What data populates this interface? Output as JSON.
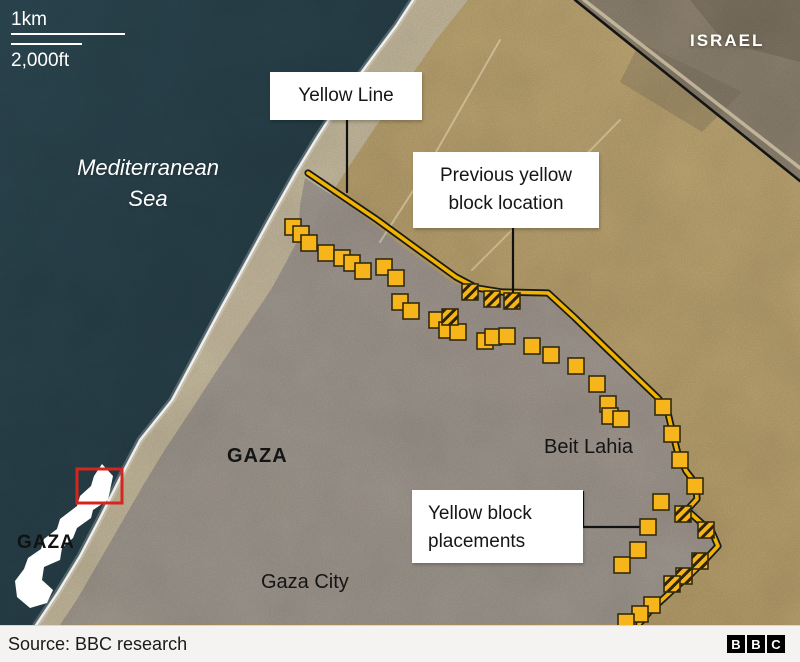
{
  "header": {
    "scale_top": "1km",
    "scale_bottom": "2,000ft"
  },
  "map_labels": {
    "israel": "ISRAEL",
    "sea": {
      "line1": "Mediterranean",
      "line2": "Sea"
    },
    "gaza_region": "GAZA",
    "beit_lahia": "Beit Lahia",
    "gaza_city": "Gaza City",
    "inset_gaza": "GAZA"
  },
  "callouts": {
    "yellow_line": {
      "label": "Yellow Line"
    },
    "previous_block": {
      "line1": "Previous yellow",
      "line2": "block location"
    },
    "placements": {
      "line1": "Yellow block",
      "line2": "placements"
    }
  },
  "footer": {
    "source": "Source: BBC research",
    "logo": [
      "B",
      "B",
      "C"
    ]
  },
  "colors": {
    "sea": "#2e4b56",
    "sand": "#d2b678",
    "israel_terrain": "#a39680",
    "urban": "#b6aea6",
    "beach": "#e3d7ba",
    "block_yellow": "#f6b61b",
    "block_border": "#332a0b",
    "line_yellow": "#f0b400",
    "line_black": "#1a1a1a",
    "border_black": "#141414",
    "highlight_red": "#d6251f",
    "label_bg": "#ffffff",
    "text_dark": "#161616",
    "footer_bg": "#f4f3f1",
    "text_white": "#ffffff"
  },
  "map_data": {
    "block_size": 16,
    "block_fill": "#f6b61b",
    "block_stroke": "#332a0b",
    "regions": [
      {
        "name": "land-sand",
        "points": [
          [
            0,
            0
          ],
          [
            800,
            0
          ],
          [
            800,
            625
          ],
          [
            0,
            625
          ]
        ],
        "fill": "url(#landGrad)"
      },
      {
        "name": "israel-terrain",
        "points": [
          [
            575,
            0
          ],
          [
            800,
            0
          ],
          [
            800,
            182
          ]
        ],
        "fill": "#a39680"
      },
      {
        "name": "israel-dark-patch-1",
        "points": [
          [
            690,
            0
          ],
          [
            800,
            0
          ],
          [
            800,
            62
          ],
          [
            724,
            42
          ]
        ],
        "fill": "#7d7260",
        "opacity": 0.45
      },
      {
        "name": "israel-dark-patch-2",
        "points": [
          [
            640,
            42
          ],
          [
            742,
            92
          ],
          [
            702,
            132
          ],
          [
            620,
            82
          ]
        ],
        "fill": "#8a7e6a",
        "opacity": 0.35
      },
      {
        "name": "beach-strip",
        "points": [
          [
            413,
            0
          ],
          [
            468,
            0
          ],
          [
            436,
            40
          ],
          [
            404,
            86
          ],
          [
            372,
            132
          ],
          [
            340,
            180
          ],
          [
            306,
            236
          ],
          [
            272,
            288
          ],
          [
            244,
            330
          ],
          [
            216,
            372
          ],
          [
            190,
            412
          ],
          [
            166,
            448
          ],
          [
            144,
            484
          ],
          [
            122,
            522
          ],
          [
            100,
            560
          ],
          [
            78,
            598
          ],
          [
            60,
            625
          ],
          [
            36,
            625
          ],
          [
            58,
            592
          ],
          [
            80,
            556
          ],
          [
            100,
            518
          ],
          [
            120,
            478
          ],
          [
            140,
            440
          ],
          [
            172,
            400
          ],
          [
            196,
            355
          ],
          [
            220,
            310
          ],
          [
            243,
            268
          ],
          [
            268,
            222
          ],
          [
            296,
            172
          ],
          [
            318,
            136
          ],
          [
            344,
            96
          ],
          [
            372,
            58
          ],
          [
            396,
            26
          ]
        ],
        "fill": "#e3d7ba",
        "opacity": 0.92
      },
      {
        "name": "urban-area",
        "points": [
          [
            305,
            178
          ],
          [
            352,
            208
          ],
          [
            402,
            246
          ],
          [
            452,
            282
          ],
          [
            480,
            292
          ],
          [
            548,
            298
          ],
          [
            592,
            340
          ],
          [
            642,
            388
          ],
          [
            663,
            412
          ],
          [
            670,
            445
          ],
          [
            684,
            477
          ],
          [
            692,
            505
          ],
          [
            706,
            524
          ],
          [
            714,
            547
          ],
          [
            698,
            568
          ],
          [
            668,
            597
          ],
          [
            638,
            624
          ],
          [
            92,
            624
          ],
          [
            60,
            625
          ],
          [
            78,
            598
          ],
          [
            100,
            560
          ],
          [
            122,
            522
          ],
          [
            144,
            484
          ],
          [
            166,
            448
          ],
          [
            190,
            412
          ],
          [
            216,
            372
          ],
          [
            244,
            330
          ],
          [
            272,
            288
          ],
          [
            298,
            240
          ],
          [
            300,
            205
          ]
        ],
        "fill": "#b6aea6",
        "opacity": 0.96
      },
      {
        "name": "sea",
        "points": [
          [
            0,
            0
          ],
          [
            413,
            0
          ],
          [
            396,
            26
          ],
          [
            372,
            58
          ],
          [
            344,
            96
          ],
          [
            318,
            136
          ],
          [
            296,
            172
          ],
          [
            268,
            222
          ],
          [
            243,
            268
          ],
          [
            220,
            310
          ],
          [
            196,
            355
          ],
          [
            172,
            400
          ],
          [
            140,
            440
          ],
          [
            120,
            478
          ],
          [
            100,
            518
          ],
          [
            80,
            556
          ],
          [
            58,
            592
          ],
          [
            36,
            625
          ],
          [
            0,
            625
          ]
        ],
        "fill": "url(#seaGrad)"
      }
    ],
    "lines": [
      {
        "name": "sand-road-1",
        "points": [
          [
            500,
            40
          ],
          [
            420,
            180
          ],
          [
            380,
            242
          ]
        ],
        "stroke": "#e8dcbc",
        "width": 2,
        "opacity": 0.5
      },
      {
        "name": "sand-road-2",
        "points": [
          [
            620,
            120
          ],
          [
            520,
            222
          ],
          [
            472,
            270
          ]
        ],
        "stroke": "#e8dcbc",
        "width": 2,
        "opacity": 0.45
      },
      {
        "name": "israel-border-road",
        "points": [
          [
            584,
            0
          ],
          [
            800,
            168
          ]
        ],
        "stroke": "#cfc3a8",
        "width": 3.5,
        "opacity": 0.8
      },
      {
        "name": "israel-border",
        "points": [
          [
            575,
            0
          ],
          [
            800,
            181
          ]
        ],
        "stroke": "#141414",
        "width": 2.6
      },
      {
        "name": "coast-surf-glow",
        "points": [
          [
            413,
            0
          ],
          [
            396,
            26
          ],
          [
            372,
            58
          ],
          [
            344,
            96
          ],
          [
            318,
            136
          ],
          [
            296,
            172
          ],
          [
            268,
            222
          ],
          [
            243,
            268
          ],
          [
            220,
            310
          ],
          [
            196,
            355
          ],
          [
            172,
            400
          ],
          [
            140,
            440
          ],
          [
            120,
            478
          ],
          [
            100,
            518
          ],
          [
            80,
            556
          ],
          [
            58,
            592
          ],
          [
            36,
            625
          ]
        ],
        "stroke": "#ffffff",
        "width": 7,
        "opacity": 0.22
      },
      {
        "name": "coast-surf",
        "points": [
          [
            413,
            0
          ],
          [
            396,
            26
          ],
          [
            372,
            58
          ],
          [
            344,
            96
          ],
          [
            318,
            136
          ],
          [
            296,
            172
          ],
          [
            268,
            222
          ],
          [
            243,
            268
          ],
          [
            220,
            310
          ],
          [
            196,
            355
          ],
          [
            172,
            400
          ],
          [
            140,
            440
          ],
          [
            120,
            478
          ],
          [
            100,
            518
          ],
          [
            80,
            556
          ],
          [
            58,
            592
          ],
          [
            36,
            625
          ]
        ],
        "stroke": "#ffffff",
        "width": 2.4,
        "opacity": 0.85
      },
      {
        "name": "yellow-line-outline",
        "points": [
          [
            308,
            173
          ],
          [
            336,
            192
          ],
          [
            376,
            219
          ],
          [
            420,
            251
          ],
          [
            456,
            277
          ],
          [
            477,
            288
          ],
          [
            502,
            292
          ],
          [
            548,
            293
          ],
          [
            574,
            317
          ],
          [
            608,
            350
          ],
          [
            658,
            398
          ],
          [
            667,
            409
          ],
          [
            672,
            430
          ],
          [
            678,
            454
          ],
          [
            686,
            471
          ],
          [
            696,
            484
          ],
          [
            697,
            499
          ],
          [
            687,
            510
          ],
          [
            698,
            520
          ],
          [
            712,
            532
          ],
          [
            718,
            546
          ],
          [
            706,
            559
          ],
          [
            690,
            575
          ],
          [
            676,
            587
          ],
          [
            663,
            599
          ],
          [
            650,
            611
          ],
          [
            639,
            624
          ]
        ],
        "stroke": "#1a1a1a",
        "width": 7.2
      },
      {
        "name": "yellow-line",
        "points": [
          [
            308,
            173
          ],
          [
            336,
            192
          ],
          [
            376,
            219
          ],
          [
            420,
            251
          ],
          [
            456,
            277
          ],
          [
            477,
            288
          ],
          [
            502,
            292
          ],
          [
            548,
            293
          ],
          [
            574,
            317
          ],
          [
            608,
            350
          ],
          [
            658,
            398
          ],
          [
            667,
            409
          ],
          [
            672,
            430
          ],
          [
            678,
            454
          ],
          [
            686,
            471
          ],
          [
            696,
            484
          ],
          [
            697,
            499
          ],
          [
            687,
            510
          ],
          [
            698,
            520
          ],
          [
            712,
            532
          ],
          [
            718,
            546
          ],
          [
            706,
            559
          ],
          [
            690,
            575
          ],
          [
            676,
            587
          ],
          [
            663,
            599
          ],
          [
            650,
            611
          ],
          [
            639,
            624
          ]
        ],
        "stroke": "#f0b400",
        "width": 3.6
      },
      {
        "name": "leader-yellow-line",
        "points": [
          [
            347,
            118
          ],
          [
            347,
            192
          ]
        ],
        "stroke": "#111111",
        "width": 2.2
      },
      {
        "name": "leader-previous-block",
        "points": [
          [
            513,
            226
          ],
          [
            513,
            294
          ]
        ],
        "stroke": "#111111",
        "width": 2.2
      },
      {
        "name": "leader-placements",
        "points": [
          [
            583,
            492
          ],
          [
            583,
            527
          ],
          [
            644,
            527
          ]
        ],
        "stroke": "#111111",
        "width": 2.2
      }
    ],
    "solid_blocks": [
      [
        293,
        227
      ],
      [
        301,
        234
      ],
      [
        309,
        243
      ],
      [
        326,
        253
      ],
      [
        342,
        258
      ],
      [
        352,
        263
      ],
      [
        363,
        271
      ],
      [
        384,
        267
      ],
      [
        396,
        278
      ],
      [
        400,
        302
      ],
      [
        411,
        311
      ],
      [
        437,
        320
      ],
      [
        447,
        330
      ],
      [
        458,
        332
      ],
      [
        485,
        341
      ],
      [
        493,
        337
      ],
      [
        507,
        336
      ],
      [
        532,
        346
      ],
      [
        551,
        355
      ],
      [
        576,
        366
      ],
      [
        597,
        384
      ],
      [
        608,
        404
      ],
      [
        610,
        416
      ],
      [
        621,
        419
      ],
      [
        663,
        407
      ],
      [
        672,
        434
      ],
      [
        680,
        460
      ],
      [
        695,
        486
      ],
      [
        661,
        502
      ],
      [
        648,
        527
      ],
      [
        638,
        550
      ],
      [
        622,
        565
      ],
      [
        652,
        605
      ],
      [
        640,
        614
      ],
      [
        626,
        622
      ]
    ],
    "hatched_blocks": [
      [
        470,
        292
      ],
      [
        492,
        299
      ],
      [
        512,
        301
      ],
      [
        450,
        317
      ],
      [
        683,
        514
      ],
      [
        706,
        530
      ],
      [
        700,
        561
      ],
      [
        684,
        576
      ],
      [
        672,
        584
      ]
    ],
    "inset_shape": [
      [
        102,
        464
      ],
      [
        113,
        476
      ],
      [
        108,
        500
      ],
      [
        93,
        510
      ],
      [
        91,
        518
      ],
      [
        77,
        528
      ],
      [
        73,
        538
      ],
      [
        62,
        548
      ],
      [
        60,
        560
      ],
      [
        44,
        567
      ],
      [
        42,
        580
      ],
      [
        53,
        590
      ],
      [
        47,
        603
      ],
      [
        30,
        608
      ],
      [
        17,
        597
      ],
      [
        15,
        581
      ],
      [
        24,
        569
      ],
      [
        28,
        558
      ],
      [
        41,
        549
      ],
      [
        44,
        539
      ],
      [
        57,
        529
      ],
      [
        60,
        519
      ],
      [
        77,
        506
      ],
      [
        80,
        496
      ],
      [
        91,
        486
      ],
      [
        94,
        476
      ]
    ],
    "red_rect": {
      "x": 77,
      "y": 469,
      "w": 45,
      "h": 34,
      "color": "#d6251f",
      "width": 3
    }
  }
}
